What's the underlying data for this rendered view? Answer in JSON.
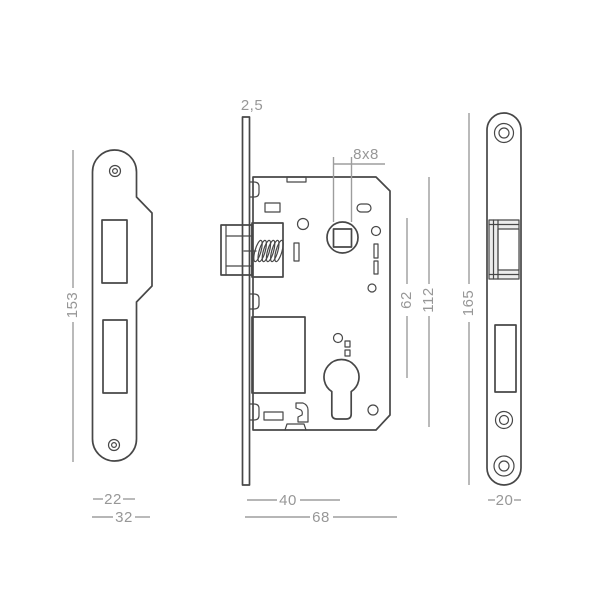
{
  "drawing": {
    "type": "technical-dimension-diagram",
    "subject": "mortise lock with strike plate and faceplate",
    "colors": {
      "outline": "#474747",
      "dimension_line": "#9d9d9d",
      "dimension_text": "#979797",
      "background": "#ffffff"
    },
    "views": {
      "strike_plate": {
        "name": "strike plate front view",
        "dimensions": {
          "height": "153",
          "plate_width": "22",
          "total_width": "32"
        }
      },
      "lock_body": {
        "name": "lock body side view",
        "dimensions": {
          "faceplate_thickness": "2,5",
          "spindle_square": "8x8",
          "cylinder_distance": "62",
          "case_height": "112",
          "backset": "40",
          "total_depth": "68"
        }
      },
      "faceplate": {
        "name": "faceplate front view",
        "dimensions": {
          "height": "165",
          "width": "20"
        }
      }
    }
  }
}
